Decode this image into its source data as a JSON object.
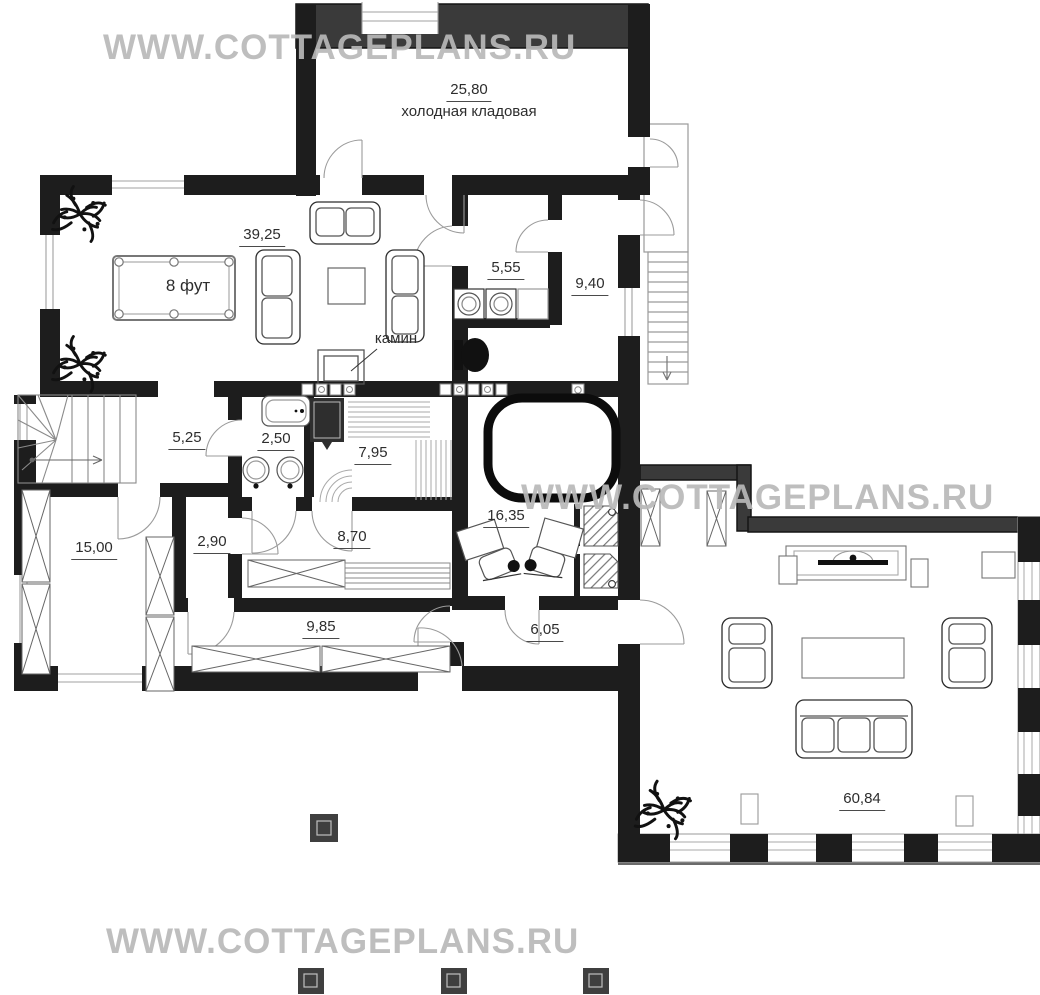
{
  "watermark": {
    "text": "WWW.COTTAGEPLANS.RU"
  },
  "rooms": [
    {
      "id": "cold-storage",
      "area": "25,80",
      "name": "холодная кладовая"
    },
    {
      "id": "billiard-room",
      "area": "39,25"
    },
    {
      "id": "laundry",
      "area": "5,55"
    },
    {
      "id": "entry-hall",
      "area": "9,40"
    },
    {
      "id": "stair-hall",
      "area": "5,25"
    },
    {
      "id": "bathroom",
      "area": "2,50"
    },
    {
      "id": "sauna",
      "area": "7,95"
    },
    {
      "id": "storage-room",
      "area": "15,00"
    },
    {
      "id": "corridor",
      "area": "2,90"
    },
    {
      "id": "lounge-room",
      "area": "8,70"
    },
    {
      "id": "spa-room",
      "area": "16,35"
    },
    {
      "id": "bedroom",
      "area": "9,85"
    },
    {
      "id": "vestibule",
      "area": "6,05"
    },
    {
      "id": "terrace",
      "area": "60,84"
    }
  ],
  "annotations": {
    "fireplace_label": "камин",
    "billiard_table_label": "8 фут"
  },
  "colors": {
    "wall": "#1d1d1d",
    "outer_wall": "#3a3a3a",
    "watermark": "#c0c0c0",
    "thin_line": "#999999"
  }
}
